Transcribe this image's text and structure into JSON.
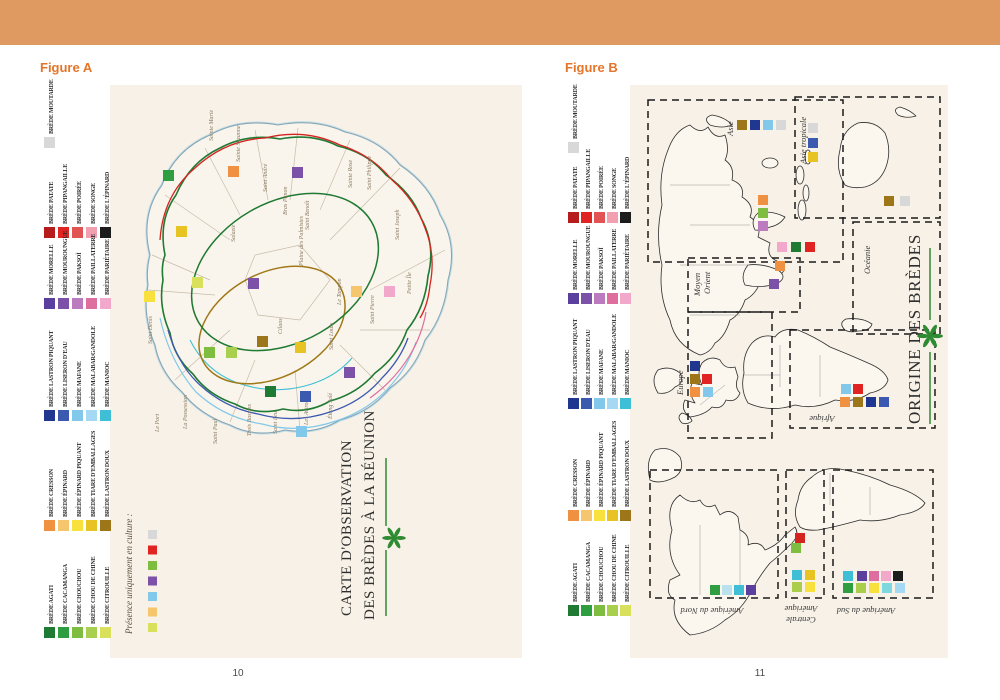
{
  "page": {
    "header_bar_color": "#DE9A61",
    "paper_color": "#F7F1E7",
    "left_page_number": "10",
    "right_page_number": "11"
  },
  "legend": {
    "groups": [
      {
        "items": [
          {
            "label": "BRÈDE MOUTARDE",
            "color": "#D8D8D8"
          }
        ]
      },
      {
        "items": [
          {
            "label": "BRÈDE PATATE",
            "color": "#B71C1C"
          },
          {
            "label": "BRÈDE PIPANGAILLE",
            "color": "#E02421"
          },
          {
            "label": "BRÈDE POIRÉE",
            "color": "#E25353"
          },
          {
            "label": "BRÈDE SONGE",
            "color": "#F2A0B0"
          },
          {
            "label": "BRÈDE L'ÉPINARD",
            "color": "#1C1C1C"
          }
        ]
      },
      {
        "items": [
          {
            "label": "BRÈDE MORELLE",
            "color": "#5B3F9E"
          },
          {
            "label": "BRÈDE MOUROUNGUE",
            "color": "#7B52A8"
          },
          {
            "label": "BRÈDE PAKSOÏ",
            "color": "#BC7BBE"
          },
          {
            "label": "BRÈDE PAILLATERRE",
            "color": "#DE6E9E"
          },
          {
            "label": "BRÈDE PARIÉTAIRE",
            "color": "#F2A8CB"
          }
        ]
      },
      {
        "items": [
          {
            "label": "BRÈDE LASTRON PIQUANT",
            "color": "#20378F"
          },
          {
            "label": "BRÈDE LISERON D'EAU",
            "color": "#3C59B0"
          },
          {
            "label": "BRÈDE MAFANE",
            "color": "#82C8EA"
          },
          {
            "label": "BRÈDE MALABAR/GANDOLE",
            "color": "#A5D8F2"
          },
          {
            "label": "BRÈDE MANIOC",
            "color": "#3FBFD6"
          }
        ]
      },
      {
        "items": [
          {
            "label": "BRÈDE CRESSON",
            "color": "#EF9140"
          },
          {
            "label": "BRÈDE ÉPINARD",
            "color": "#F6C66F"
          },
          {
            "label": "BRÈDE ÉPINARD PIQUANT",
            "color": "#F8E13D"
          },
          {
            "label": "BRÈDE TIARE D'EMBALLAGES",
            "color": "#E7C324"
          },
          {
            "label": "BRÈDE LASTRON DOUX",
            "color": "#9C7618"
          }
        ]
      },
      {
        "items": [
          {
            "label": "BRÈDE AGATI",
            "color": "#1F7A33"
          },
          {
            "label": "BRÈDE CACAMANGA",
            "color": "#2F9E41"
          },
          {
            "label": "BRÈDE CHOUCHOU",
            "color": "#7EBD3F"
          },
          {
            "label": "BRÈDE CHOU DE CHINE",
            "color": "#A8CF4D"
          },
          {
            "label": "BRÈDE CITROUILLE",
            "color": "#D8E05C"
          }
        ]
      }
    ]
  },
  "figure_a": {
    "label": "Figure A",
    "title_line1": "CARTE D'OBSERVATION",
    "title_line2": "DES BRÈDES À LA RÉUNION",
    "note_label": "Présence uniquement en culture :",
    "note_colors": [
      "#D8D8D8",
      "#E02421",
      "#7EBD3F",
      "#7B52A8",
      "#82C8EA",
      "#F6C66F",
      "#D8E05C"
    ],
    "contour_colors": {
      "reef": "#C4DEE6",
      "coast": "#87A6B6",
      "green": "#1F7A33",
      "red": "#D42420",
      "blue": "#3C59B0",
      "light_blue": "#82C8EA",
      "cyan": "#3FBFD6",
      "pink": "#DE6E9E",
      "gold": "#A07818"
    },
    "communes": [
      {
        "name": "Sainte Marie",
        "x": 213,
        "y": 141
      },
      {
        "name": "Sainte Suzanne",
        "x": 240,
        "y": 162
      },
      {
        "name": "Saint André",
        "x": 267,
        "y": 192
      },
      {
        "name": "Bras Panon",
        "x": 287,
        "y": 215
      },
      {
        "name": "Saint Benoît",
        "x": 309,
        "y": 230
      },
      {
        "name": "Sainte Rose",
        "x": 352,
        "y": 188
      },
      {
        "name": "Saint Philippe",
        "x": 371,
        "y": 190
      },
      {
        "name": "Saint Joseph",
        "x": 399,
        "y": 240
      },
      {
        "name": "Saint Denis",
        "x": 152,
        "y": 344
      },
      {
        "name": "Salazie",
        "x": 235,
        "y": 242
      },
      {
        "name": "Plaine des Palmistes",
        "x": 303,
        "y": 266
      },
      {
        "name": "Cilaos",
        "x": 282,
        "y": 334
      },
      {
        "name": "Le Tampon",
        "x": 341,
        "y": 305
      },
      {
        "name": "Saint Pierre",
        "x": 374,
        "y": 324
      },
      {
        "name": "Petite Île",
        "x": 411,
        "y": 294
      },
      {
        "name": "Saint Louis",
        "x": 333,
        "y": 350
      },
      {
        "name": "Étang Salé",
        "x": 332,
        "y": 419
      },
      {
        "name": "Les Avirons",
        "x": 308,
        "y": 425
      },
      {
        "name": "Saint Leu",
        "x": 277,
        "y": 434
      },
      {
        "name": "Trois Bassins",
        "x": 251,
        "y": 436
      },
      {
        "name": "Saint Paul",
        "x": 217,
        "y": 444
      },
      {
        "name": "La Possession",
        "x": 187,
        "y": 429
      },
      {
        "name": "Le Port",
        "x": 159,
        "y": 432
      }
    ],
    "observations": [
      {
        "x": 163,
        "y": 170,
        "color": "#2F9E41"
      },
      {
        "x": 228,
        "y": 166,
        "color": "#EF9140"
      },
      {
        "x": 292,
        "y": 167,
        "color": "#7B52A8"
      },
      {
        "x": 176,
        "y": 226,
        "color": "#E7C324"
      },
      {
        "x": 144,
        "y": 291,
        "color": "#F8E13D"
      },
      {
        "x": 192,
        "y": 277,
        "color": "#D8E05C"
      },
      {
        "x": 248,
        "y": 278,
        "color": "#7B52A8"
      },
      {
        "x": 351,
        "y": 286,
        "color": "#F6C66F"
      },
      {
        "x": 384,
        "y": 286,
        "color": "#F2A8CB"
      },
      {
        "x": 204,
        "y": 347,
        "color": "#7EBD3F"
      },
      {
        "x": 226,
        "y": 347,
        "color": "#A8CF4D"
      },
      {
        "x": 257,
        "y": 336,
        "color": "#9C7618"
      },
      {
        "x": 295,
        "y": 342,
        "color": "#E7C324"
      },
      {
        "x": 265,
        "y": 386,
        "color": "#1F7A33"
      },
      {
        "x": 300,
        "y": 391,
        "color": "#3C59B0"
      },
      {
        "x": 344,
        "y": 367,
        "color": "#7B52A8"
      },
      {
        "x": 296,
        "y": 426,
        "color": "#82C8EA"
      }
    ]
  },
  "figure_b": {
    "label": "Figure B",
    "title": "ORIGINE DES BRÈDES",
    "boxes": [
      {
        "name": "asie",
        "x": 648,
        "y": 100,
        "w": 195,
        "h": 162
      },
      {
        "name": "asie-tropicale",
        "x": 795,
        "y": 97,
        "w": 145,
        "h": 121
      },
      {
        "name": "oceanie",
        "x": 853,
        "y": 222,
        "w": 87,
        "h": 112
      },
      {
        "name": "moyen-orient",
        "x": 688,
        "y": 258,
        "w": 112,
        "h": 54
      },
      {
        "name": "europe",
        "x": 688,
        "y": 312,
        "w": 84,
        "h": 126
      },
      {
        "name": "afrique",
        "x": 790,
        "y": 330,
        "w": 145,
        "h": 98
      },
      {
        "name": "amerique-du-nord",
        "x": 650,
        "y": 470,
        "w": 128,
        "h": 128
      },
      {
        "name": "amerique-centrale",
        "x": 786,
        "y": 470,
        "w": 38,
        "h": 128
      },
      {
        "name": "amerique-du-sud",
        "x": 833,
        "y": 470,
        "w": 100,
        "h": 128
      }
    ],
    "regions": [
      {
        "name": "Asie",
        "x": 733,
        "y": 136,
        "angle": -90
      },
      {
        "name": "Asie tropicale",
        "x": 806,
        "y": 164,
        "angle": -90
      },
      {
        "name": "Océanie",
        "x": 870,
        "y": 274,
        "angle": -90
      },
      {
        "name": "Moyen",
        "x": 700,
        "y": 296,
        "angle": -90
      },
      {
        "name": "Orient",
        "x": 710,
        "y": 294,
        "angle": -90
      },
      {
        "name": "Europe",
        "x": 683,
        "y": 395,
        "angle": -90
      },
      {
        "name": "Afrique",
        "x": 822,
        "y": 416,
        "angle": 180
      },
      {
        "name": "Amérique du Nord",
        "x": 712,
        "y": 608,
        "angle": 180
      },
      {
        "name": "Amérique",
        "x": 801,
        "y": 606,
        "angle": 180
      },
      {
        "name": "Centrale",
        "x": 801,
        "y": 617,
        "angle": 180
      },
      {
        "name": "Amérique du Sud",
        "x": 866,
        "y": 608,
        "angle": 180
      }
    ],
    "map_squares": [
      {
        "x": 737,
        "y": 120,
        "color": "#9C7618"
      },
      {
        "x": 750,
        "y": 120,
        "color": "#20378F"
      },
      {
        "x": 763,
        "y": 120,
        "color": "#82C8EA"
      },
      {
        "x": 776,
        "y": 120,
        "color": "#D8D8D8"
      },
      {
        "x": 808,
        "y": 123,
        "color": "#D8D8D8"
      },
      {
        "x": 808,
        "y": 138,
        "color": "#3C59B0"
      },
      {
        "x": 808,
        "y": 152,
        "color": "#E7C324"
      },
      {
        "x": 884,
        "y": 196,
        "color": "#9C7618"
      },
      {
        "x": 900,
        "y": 196,
        "color": "#D8D8D8"
      },
      {
        "x": 758,
        "y": 195,
        "color": "#EF9140"
      },
      {
        "x": 758,
        "y": 208,
        "color": "#7EBD3F"
      },
      {
        "x": 758,
        "y": 221,
        "color": "#BC7BBE"
      },
      {
        "x": 777,
        "y": 242,
        "color": "#F2A8CB"
      },
      {
        "x": 791,
        "y": 242,
        "color": "#1F7A33"
      },
      {
        "x": 805,
        "y": 242,
        "color": "#E02421"
      },
      {
        "x": 775,
        "y": 261,
        "color": "#EF9140"
      },
      {
        "x": 769,
        "y": 279,
        "color": "#7B52A8"
      },
      {
        "x": 690,
        "y": 361,
        "color": "#20378F"
      },
      {
        "x": 690,
        "y": 374,
        "color": "#9C7618"
      },
      {
        "x": 702,
        "y": 374,
        "color": "#E02421"
      },
      {
        "x": 690,
        "y": 387,
        "color": "#EF9140"
      },
      {
        "x": 703,
        "y": 387,
        "color": "#82C8EA"
      },
      {
        "x": 841,
        "y": 384,
        "color": "#82C8EA"
      },
      {
        "x": 853,
        "y": 384,
        "color": "#E02421"
      },
      {
        "x": 840,
        "y": 397,
        "color": "#EF9140"
      },
      {
        "x": 853,
        "y": 397,
        "color": "#9C7618"
      },
      {
        "x": 866,
        "y": 397,
        "color": "#20378F"
      },
      {
        "x": 879,
        "y": 397,
        "color": "#3C59B0"
      },
      {
        "x": 710,
        "y": 585,
        "color": "#2F9E41"
      },
      {
        "x": 722,
        "y": 585,
        "color": "#B9E2EE"
      },
      {
        "x": 734,
        "y": 585,
        "color": "#3FBFD6"
      },
      {
        "x": 746,
        "y": 585,
        "color": "#5B3F9E"
      },
      {
        "x": 795,
        "y": 533,
        "color": "#D42420"
      },
      {
        "x": 791,
        "y": 543,
        "color": "#7EBD3F"
      },
      {
        "x": 792,
        "y": 570,
        "color": "#3FBFD6"
      },
      {
        "x": 805,
        "y": 570,
        "color": "#E7C324"
      },
      {
        "x": 792,
        "y": 582,
        "color": "#AACD4B"
      },
      {
        "x": 805,
        "y": 582,
        "color": "#F8E13D"
      },
      {
        "x": 843,
        "y": 571,
        "color": "#3FBFD6"
      },
      {
        "x": 857,
        "y": 571,
        "color": "#5B3F9E"
      },
      {
        "x": 869,
        "y": 571,
        "color": "#DE6E9E"
      },
      {
        "x": 881,
        "y": 571,
        "color": "#F2A8CB"
      },
      {
        "x": 893,
        "y": 571,
        "color": "#1C1C1C"
      },
      {
        "x": 843,
        "y": 583,
        "color": "#2F9E41"
      },
      {
        "x": 856,
        "y": 583,
        "color": "#AACD4B"
      },
      {
        "x": 869,
        "y": 583,
        "color": "#F8E13D"
      },
      {
        "x": 882,
        "y": 583,
        "color": "#7FD8E0"
      },
      {
        "x": 895,
        "y": 583,
        "color": "#A5D8F2"
      }
    ]
  }
}
